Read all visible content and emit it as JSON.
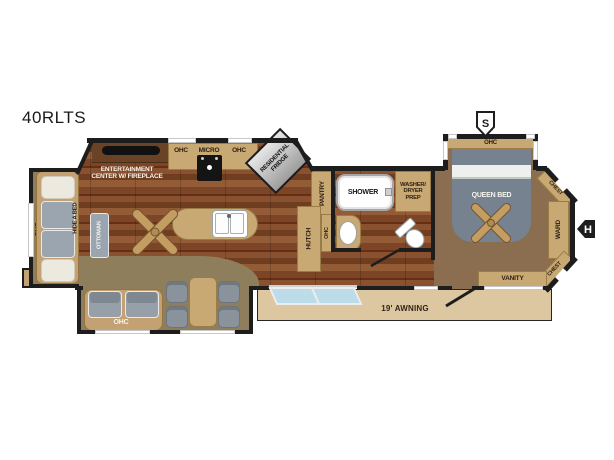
{
  "title": "40RLTS",
  "markers": {
    "s": "S",
    "h": "H"
  },
  "living_room": {
    "slide_ohc": "OHC",
    "hide_a_bed": "HIDE A BED",
    "ottoman": "OTTOMAN",
    "theater_ohc": "OHC"
  },
  "kitchen": {
    "entertainment_line1": "ENTERTAINMENT",
    "entertainment_line2": "CENTER W/ FIREPLACE",
    "ohc_left": "OHC",
    "micro": "MICRO",
    "ohc_right": "OHC",
    "fridge_line1": "RESIDENTIAL",
    "fridge_line2": "FRIDGE",
    "pantry": "PANTRY",
    "hutch": "HUTCH",
    "hutch_ohc": "OHC"
  },
  "bathroom": {
    "shower": "SHOWER",
    "washer_prep_line1": "WASHER/",
    "washer_prep_line2": "DRYER",
    "washer_prep_line3": "PREP"
  },
  "bedroom": {
    "ohc": "OHC",
    "queen_bed": "QUEEN BED",
    "chest_top": "CHEST",
    "ward": "WARD",
    "chest_bottom": "CHEST",
    "vanity": "VANITY"
  },
  "exterior": {
    "awning": "19' AWNING"
  },
  "colors": {
    "wall": "#1d1d1d",
    "cabinet": "#c8a873",
    "wood_floor": "#7d4527",
    "slide_floor": "#8f7e5b",
    "carpet": "#8a6e4f",
    "awning": "#dcc7a1",
    "upholstery": "#9aa5b0",
    "bed": "#76828f",
    "step_glass": "#bcdcea"
  }
}
